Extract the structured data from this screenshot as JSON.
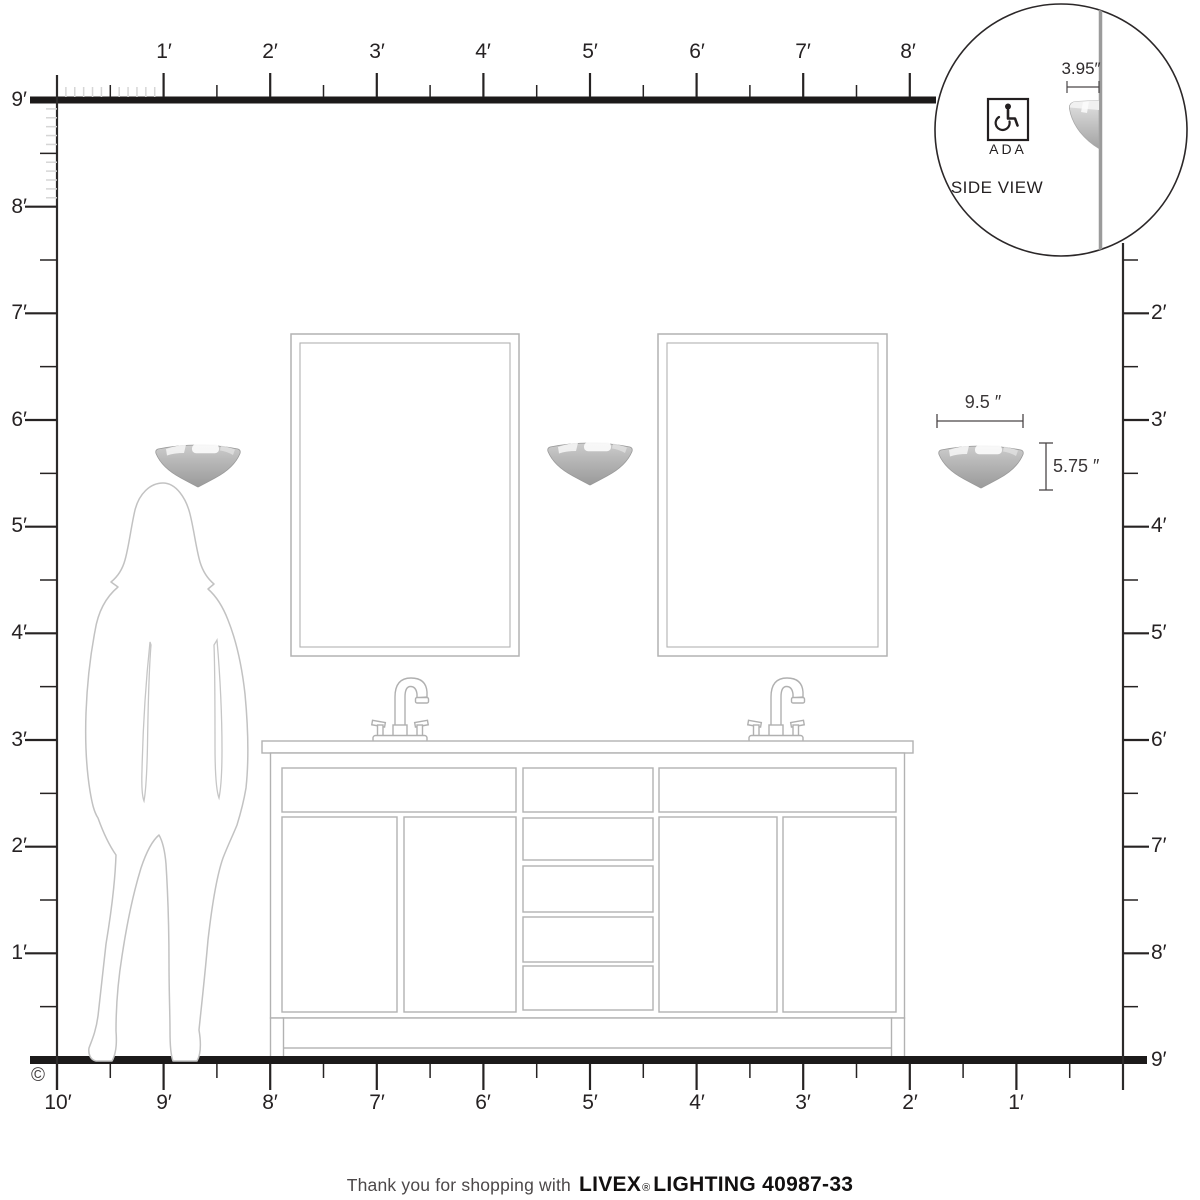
{
  "rulers": {
    "top_labels": [
      "1′",
      "2′",
      "3′",
      "4′",
      "5′",
      "6′",
      "7′",
      "8′"
    ],
    "left_labels": [
      "9′",
      "8′",
      "7′",
      "6′",
      "5′",
      "4′",
      "3′",
      "2′",
      "1′"
    ],
    "right_labels": [
      "2′",
      "3′",
      "4′",
      "5′",
      "6′",
      "7′",
      "8′",
      "9′"
    ],
    "bottom_labels": [
      "10′",
      "9′",
      "8′",
      "7′",
      "6′",
      "5′",
      "4′",
      "3′",
      "2′",
      "1′"
    ]
  },
  "sconce_dimensions": {
    "width": "9.5 ″",
    "height": "5.75 ″"
  },
  "inset": {
    "depth_dimension": "3.95″",
    "ada_label": "ADA",
    "view_label": "SIDE VIEW"
  },
  "copyright_symbol": "©",
  "footer": {
    "prefix": "Thank you for shopping with",
    "brand": "LIVEX",
    "registered": "®",
    "suffix": "LIGHTING 40987-33"
  }
}
